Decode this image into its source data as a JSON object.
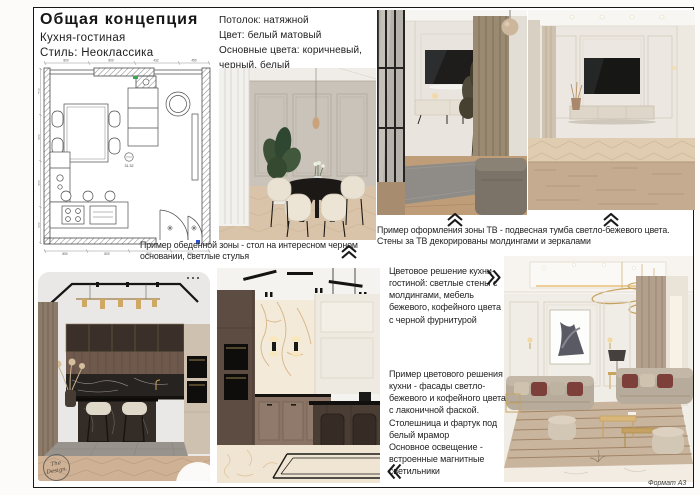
{
  "page": {
    "title": "Общая концепция",
    "subtitle": "Кухня-гостиная",
    "style_line": "Стиль: Неоклассика",
    "format_label": "Формат А3",
    "watermark": "The Design."
  },
  "specs": {
    "ceiling": "Потолок: натяжной",
    "ceiling_color": "Цвет: белый матовый",
    "main_colors": "Основные цвета: коричневый, черный, белый"
  },
  "captions": {
    "dining": "Пример обеденной зоны - стол на интересном черном основании, светлые стулья",
    "tv_zone": "Пример оформления зоны ТВ - подвесная тумба светло-бежевого цвета. Стены за ТВ декорированы молдингами и зеркалами",
    "color_scheme": "Цветовое решение кухни-гостиной: светлые стены с молдингами, мебель бежевого, кофейного цвета с черной фурнитурой",
    "kitchen_colors": "Пример цветового решения кухни - фасады светло-бежевого и кофейного цвета с лаконичной фаской. Столешница и фартук под белый мрамор",
    "lighting": "Основное освещение - встроенные магнитные светильники"
  },
  "plan": {
    "area_label": "31.32",
    "dims_top": [
      "800",
      "800",
      "432",
      "450"
    ],
    "dims_bottom": [
      "850",
      "800",
      "800",
      "800"
    ],
    "dims_left": [
      "450",
      "800",
      "800",
      "600"
    ]
  },
  "colors": {
    "ink": "#171717",
    "accent_green": "#35a854",
    "accent_blue": "#2d4fd0",
    "wood_beige": "#d9c3a9",
    "coffee_brown": "#5c4c41",
    "cream": "#e9e2d3"
  }
}
